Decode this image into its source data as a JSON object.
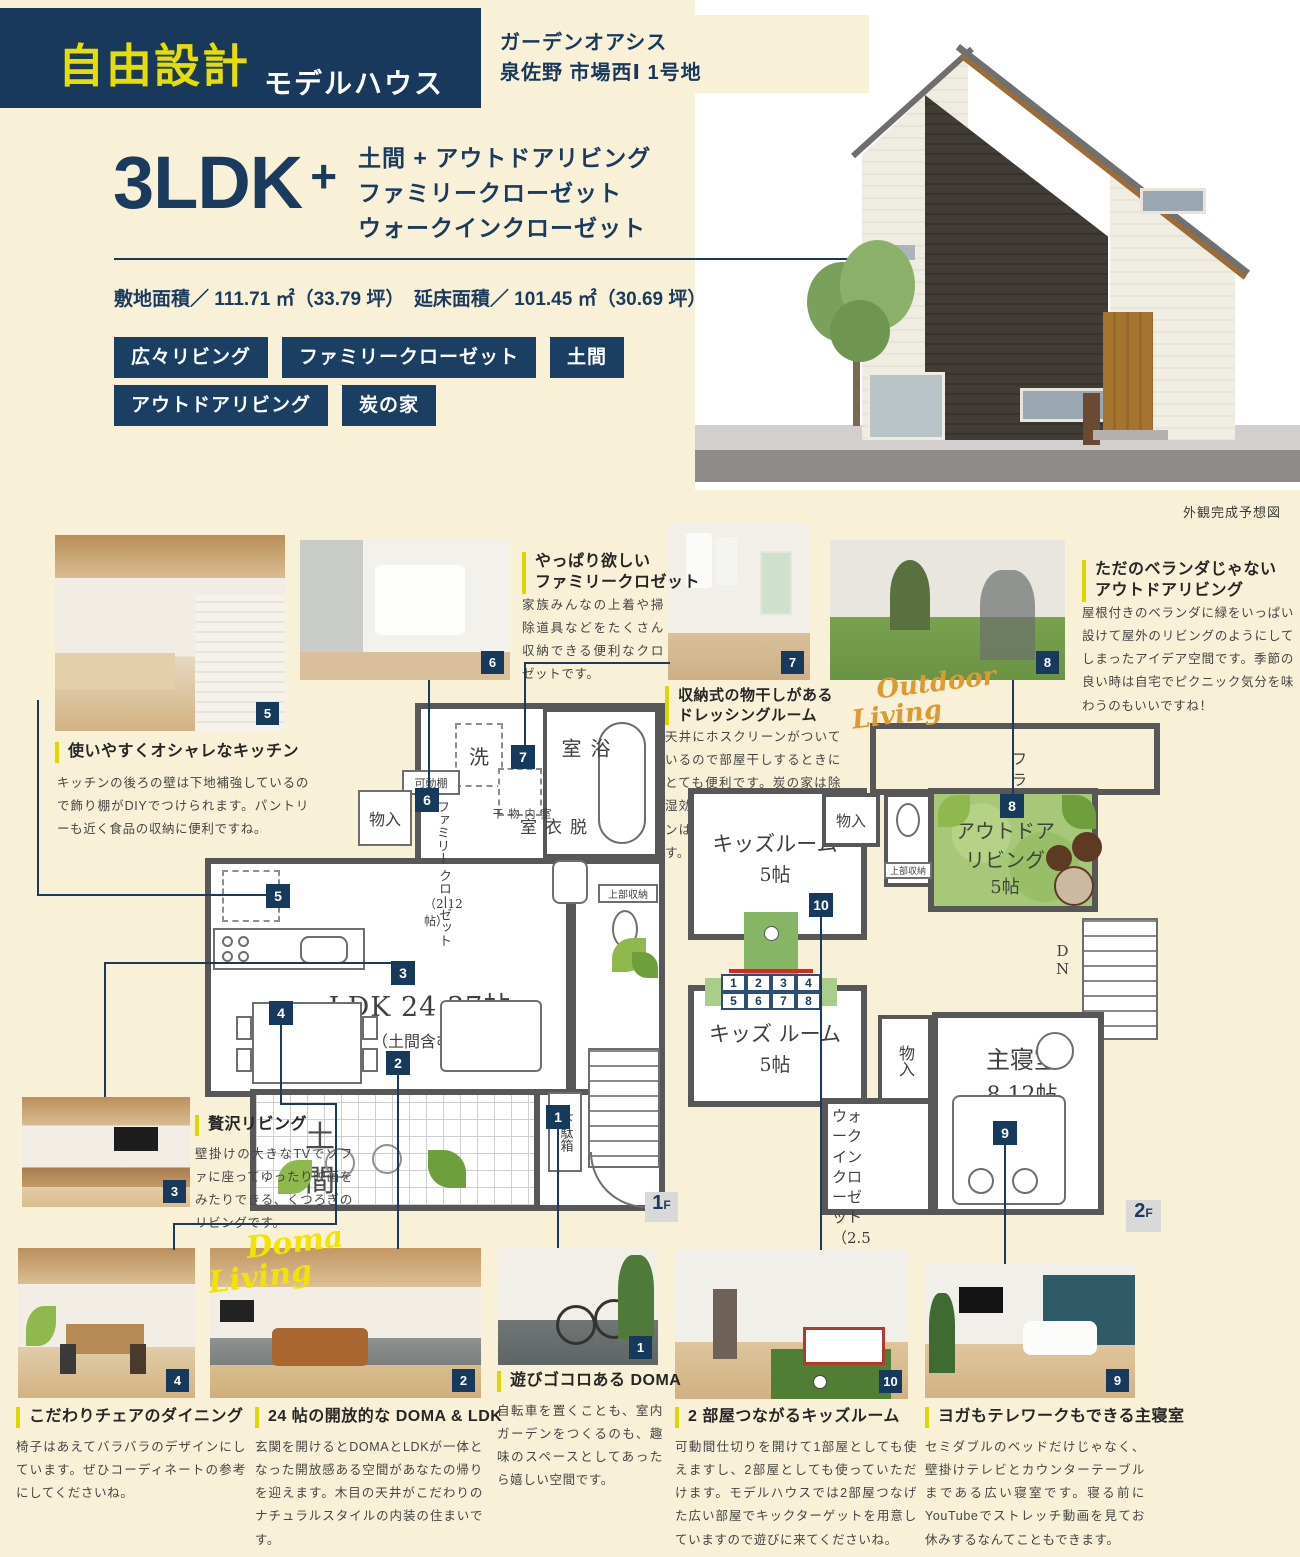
{
  "header": {
    "badge_title": "自由設計",
    "badge_subtitle": "モデルハウス",
    "location_line1": "ガーデンオアシス",
    "location_line2": "泉佐野 市場西Ⅰ 1号地"
  },
  "hero": {
    "ldk": "3LDK",
    "plus": "+",
    "feature1": "土間 + アウトドアリビング",
    "feature2": "ファミリークローゼット",
    "feature3": "ウォークインクローゼット",
    "area_line": "敷地面積／ 111.71 ㎡（33.79 坪）　延床面積／ 101.45 ㎡（30.69 坪）",
    "tag1": "広々リビング",
    "tag2": "ファミリークローゼット",
    "tag3": "土間",
    "tag4": "アウトドアリビング",
    "tag5": "炭の家",
    "render_caption": "外観完成予想図"
  },
  "script_labels": {
    "doma1": "Doma",
    "doma2": "Living",
    "outdoor1": "Outdoor",
    "outdoor2": "Living"
  },
  "captions": {
    "c5": {
      "num": "5",
      "t1": "使いやすくオシャレなキッチン",
      "body": "キッチンの後ろの壁は下地補強しているので飾り棚がDIYでつけられます。パントリーも近く食品の収納に便利ですね。"
    },
    "c6": {
      "num": "6",
      "t1": "やっぱり欲しい",
      "t2": "ファミリークロゼット",
      "body": "家族みんなの上着や掃除道具などをたくさん収納できる便利なクロゼットです。"
    },
    "c7": {
      "num": "7",
      "t1": "収納式の物干しがある",
      "t2": "ドレッシングルーム",
      "body": "天井にホスクリーンがついているので部屋干しするときにとても便利です。炭の家は除湿効果もあるのでホスクリーンはオススメの組み合わせです。"
    },
    "c8": {
      "num": "8",
      "t1": "ただのベランダじゃない",
      "t2": "アウトドアリビング",
      "body": "屋根付きのベランダに緑をいっぱい設けて屋外のリビングのようにしてしまったアイデア空間です。季節の良い時は自宅でピクニック気分を味わうのもいいですね！"
    },
    "c3": {
      "num": "3",
      "t1": "贅沢リビング",
      "body": "壁掛けの大きなTVでソファに座ってゆったり映画をみたりできる、くつろぎのリビングです。"
    },
    "c4": {
      "num": "4",
      "t1": "こだわりチェアのダイニング",
      "body": "椅子はあえてバラバラのデザインにしています。ぜひコーディネートの参考にしてくださいね。"
    },
    "c2": {
      "num": "2",
      "t1": "24 帖の開放的な DOMA & LDK",
      "body": "玄関を開けるとDOMAとLDKが一体となった開放感ある空間があなたの帰りを迎えます。木目の天井がこだわりのナチュラルスタイルの内装の住まいです。"
    },
    "c1": {
      "num": "1",
      "t1": "遊びゴコロある DOMA",
      "body": "自転車を置くことも、室内ガーデンをつくるのも、趣味のスペースとしてあったら嬉しい空間です。"
    },
    "c10": {
      "num": "10",
      "t1": "2 部屋つながるキッズルーム",
      "body": "可動間仕切りを開けて1部屋としても使えますし、2部屋としても使っていただけます。モデルハウスでは2部屋つなげた広い部屋でキックターゲットを用意していますので遊びに来てくださいね。"
    },
    "c9": {
      "num": "9",
      "t1": "ヨガもテレワークもできる主寝室",
      "body": "セミダブルのベッドだけじゃなく、壁掛けテレビとカウンターテーブルまである広い寝室です。寝る前にYouTubeでストレッチ動画を見てお休みするなんてこともできます。"
    }
  },
  "plan1f": {
    "floor": "1",
    "floor_suffix": "F",
    "ldk": "LDK 24.37帖",
    "ldk_sub": "（土間含む）",
    "doma": "土間",
    "bath": "浴室",
    "wash": "洗",
    "dressing": "脱衣室",
    "movable_shelf": "可動棚",
    "closet_small": "物入",
    "family_closet_a": "ファミリー",
    "family_closet_b": "クローゼット",
    "family_closet_c": "（2.12帖）",
    "indoor_drying": "室内物干",
    "upper_storage": "上部収納",
    "shoe_box": "下駄箱",
    "up": "UP"
  },
  "plan2f": {
    "floor": "2",
    "floor_suffix": "F",
    "flat_roof": "フラットルーフ",
    "kids1_a": "キッズルーム",
    "kids1_b": "5帖",
    "kids2_a": "キッズ ルーム",
    "kids2_b": "5帖",
    "outdoor_a": "アウトドア",
    "outdoor_b": "リビング",
    "outdoor_c": "5帖",
    "closet_top": "物入",
    "upper_storage": "上部収納",
    "closet_mid": "物入",
    "wic_a": "ウォークイン",
    "wic_b": "クローゼット",
    "wic_c": "（2.5帖）",
    "master_a": "主寝室",
    "master_b": "8.12帖",
    "dn_d": "D",
    "dn_n": "N",
    "kick": [
      "1",
      "2",
      "3",
      "4",
      "5",
      "6",
      "7",
      "8"
    ]
  }
}
